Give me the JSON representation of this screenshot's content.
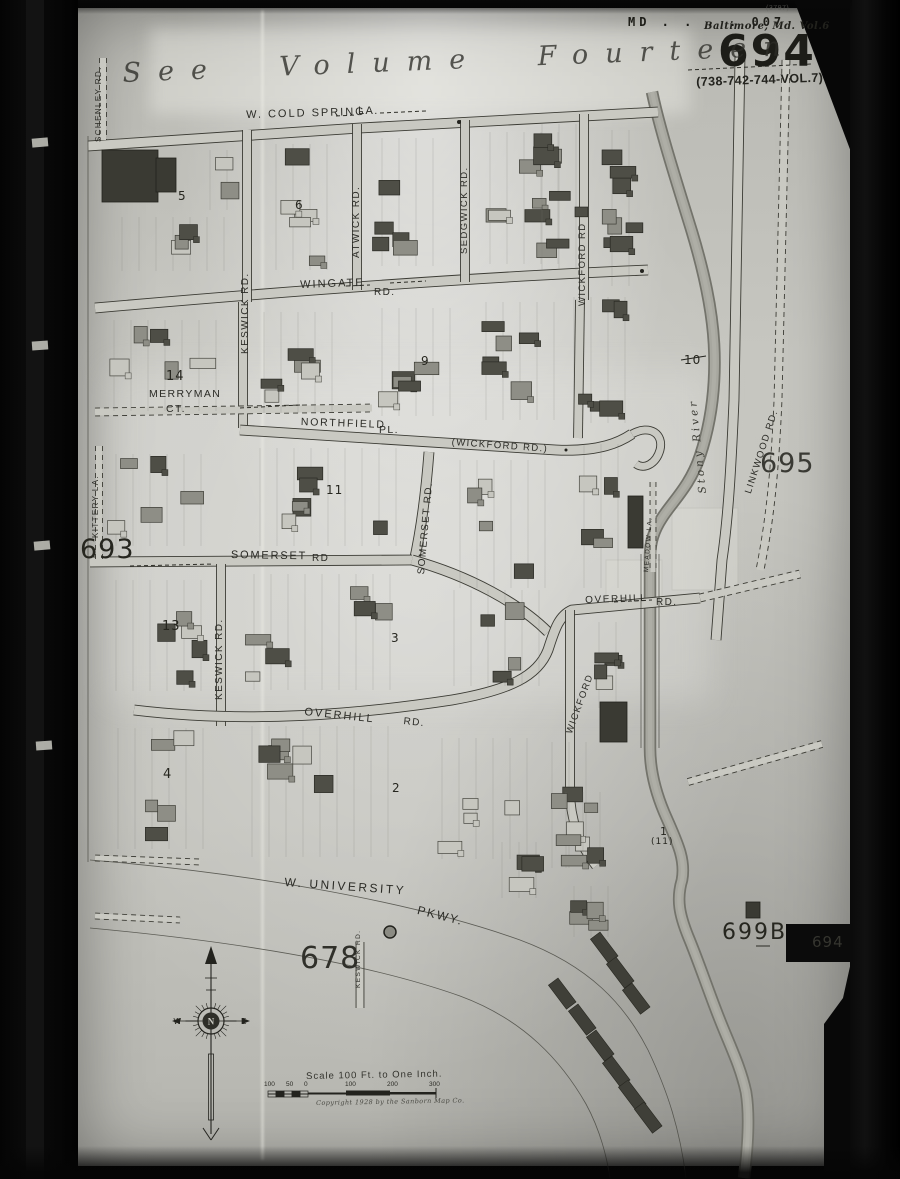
{
  "sheet": {
    "stamp": "MD . . . . 007",
    "volume_title": "Baltimore, Md. Vol.6",
    "sheet_number": "694",
    "volume_ref": "(738-742-744-VOL.7)",
    "corner_note": "(3797)",
    "see_volume_note": "See Volume Fourteen",
    "film_tab_number": "694"
  },
  "adjacent_sheets": {
    "left": "693",
    "right": "695",
    "bottom": "678",
    "bottom_right": "699B"
  },
  "streets": {
    "cold_spring": "W. COLD SPRING",
    "cold_spring_type": "LA.",
    "wingate": "WINGATE",
    "wingate_type": "RD.",
    "keswick_upper": "KESWICK RD.",
    "atwick": "ATWICK RD.",
    "sedgwick": "SEDGWICK RD.",
    "wickford_upper": "WICKFORD RD",
    "merryman": "MERRYMAN",
    "merryman_type": "CT.",
    "northfield": "NORTHFIELD",
    "northfield_type": "PL.",
    "wickford_alias": "(WICKFORD RD.)",
    "somerset_vertical": "SOMERSET RD.",
    "somerset": "SOMERSET",
    "somerset_type": "RD",
    "keswick_mid": "KESWICK RD.",
    "overhill_west": "OVERHILL",
    "overhill_west_type": "RD.",
    "overhill_east": "OVERHILL",
    "overhill_east_type": "RD.",
    "wickford_lower": "WICKFORD",
    "meadow": "MEADOW LA.",
    "linkwood": "LINKWOOD RD.",
    "schenley": "SCHENLEY RD.",
    "kittery": "KITTERY LA.",
    "university": "W. UNIVERSITY",
    "university_type": "PKWY.",
    "keswick_stub": "KESWICK RD."
  },
  "water": {
    "stony_river": "Stony River"
  },
  "block_numbers": {
    "one": "1",
    "one_sub": "(11)",
    "two": "2",
    "three": "3",
    "four": "4",
    "five": "5",
    "six": "6",
    "nine": "9",
    "ten": "10",
    "eleven": "11",
    "thirteen": "13",
    "fourteen": "14"
  },
  "compass": {
    "north": "N",
    "west": "W",
    "east": "E"
  },
  "scale_bar": {
    "title": "Scale 100 Ft. to One Inch.",
    "ticks": [
      "100",
      "50",
      "0",
      "100",
      "200",
      "300"
    ],
    "copyright": "Copyright 1928 by the Sanborn Map Co."
  }
}
